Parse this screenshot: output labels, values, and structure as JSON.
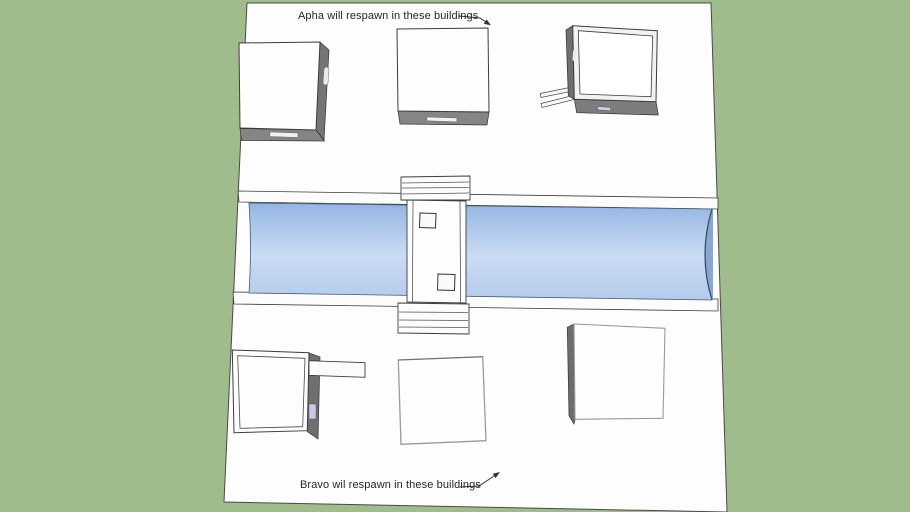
{
  "annotations": {
    "alpha": "Apha will respawn in these buildings",
    "bravo": "Bravo wil respawn in these buildings"
  },
  "colors": {
    "background_green": "#a0bb8c",
    "ground_white": "#fdfdfd",
    "edge_outline": "#3d3d3d",
    "water_top": "#93b5e2",
    "water_mid": "#cbdcf4",
    "water_bottom": "#b4cbeb",
    "water_endcap": "#88a7d3",
    "building_side_gray": "#757575",
    "building_front_gray": "#858585",
    "door_slit_white": "#f2f2f2",
    "window_lavender": "#c9c9f0",
    "annotation_text": "#262626"
  }
}
